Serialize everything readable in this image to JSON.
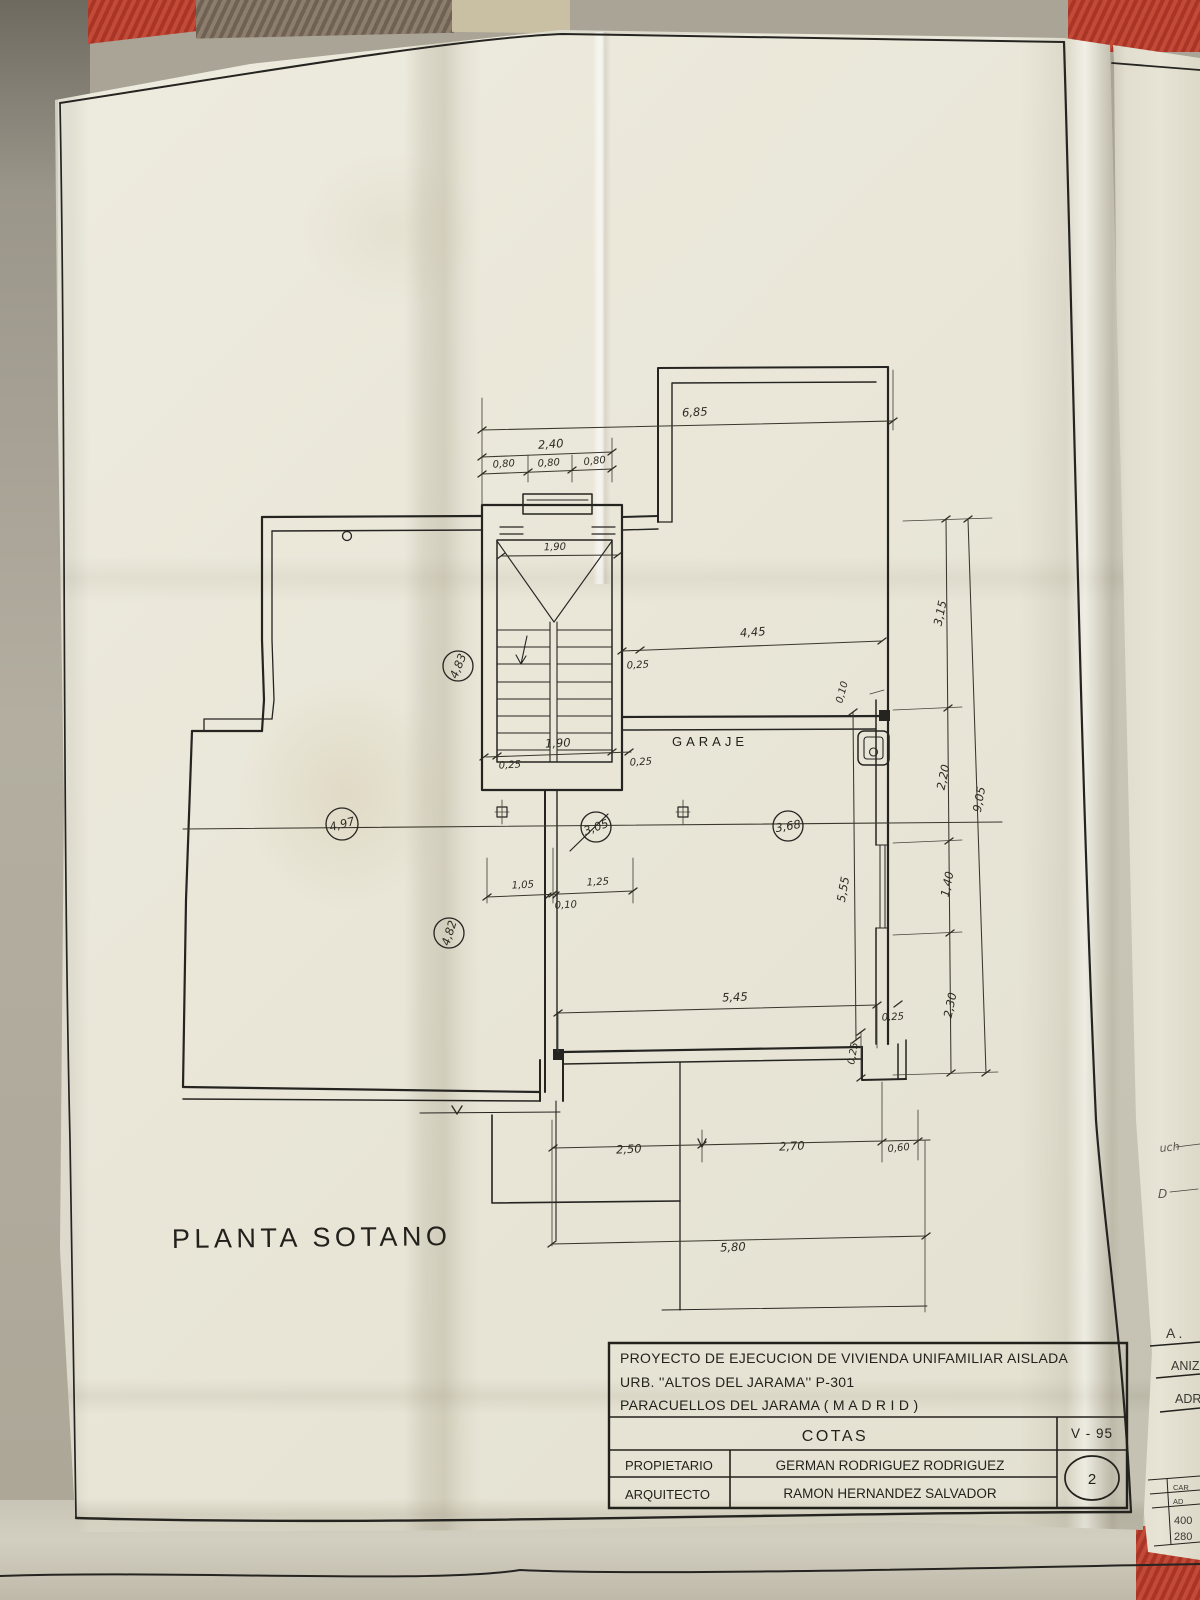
{
  "plan": {
    "title": "PLANTA SOTANO",
    "room": "GARAJE"
  },
  "title_block": {
    "project_line1": "PROYECTO DE EJECUCION DE VIVIENDA UNIFAMILIAR AISLADA",
    "project_line2": "URB. ''ALTOS DEL JARAMA''  P-301",
    "project_line3": "PARACUELLOS DEL JARAMA ( M A D R I D )",
    "drawing_title": "COTAS",
    "plan_code": "V - 95",
    "owner_label": "PROPIETARIO",
    "owner_name": "GERMAN  RODRIGUEZ  RODRIGUEZ",
    "architect_label": "ARQUITECTO",
    "architect_name": "RAMON  HERNANDEZ  SALVADOR",
    "sheet_number": "2"
  },
  "dims": {
    "overall_top": "6,85",
    "porch_total": "2,40",
    "porch_a": "0,80",
    "porch_b": "0,80",
    "porch_c": "0,80",
    "stair_top": "1,90",
    "stair_bottom": "1,90",
    "wall_left": "0,25",
    "wall_right": "0,25",
    "wall_top": "0,25",
    "garage_width": "4,45",
    "offset_top": "0,10",
    "hall_a": "1,05",
    "hall_b": "1,25",
    "hall_offset": "0,10",
    "garage_depth": "5,55",
    "garage_bottom": "5,45",
    "wall_bottom_h": "0,25",
    "wall_bottom_v": "0,25",
    "right_a": "3,15",
    "right_b": "2,20",
    "right_c": "1,40",
    "right_d": "2,30",
    "right_total": "9,05",
    "low_a": "2,50",
    "low_b": "2,70",
    "low_c": "0,60",
    "low_total": "5,80"
  },
  "circled": {
    "a": "4,83",
    "b": "4,97",
    "c": "4,82",
    "d": "3,05",
    "e": "3,68"
  },
  "side_sheet": {
    "f_a": "A .",
    "f_aniz": "ANIZ",
    "f_adr": "ADR",
    "f_uch": "uch",
    "f_d": "D",
    "t_car": "CAR",
    "t_ad": "AD",
    "t_400": "400",
    "t_280": "280"
  },
  "colors": {
    "fabric_red": "#b23a2b",
    "paper": "#eae7d9",
    "ink": "#262421"
  }
}
